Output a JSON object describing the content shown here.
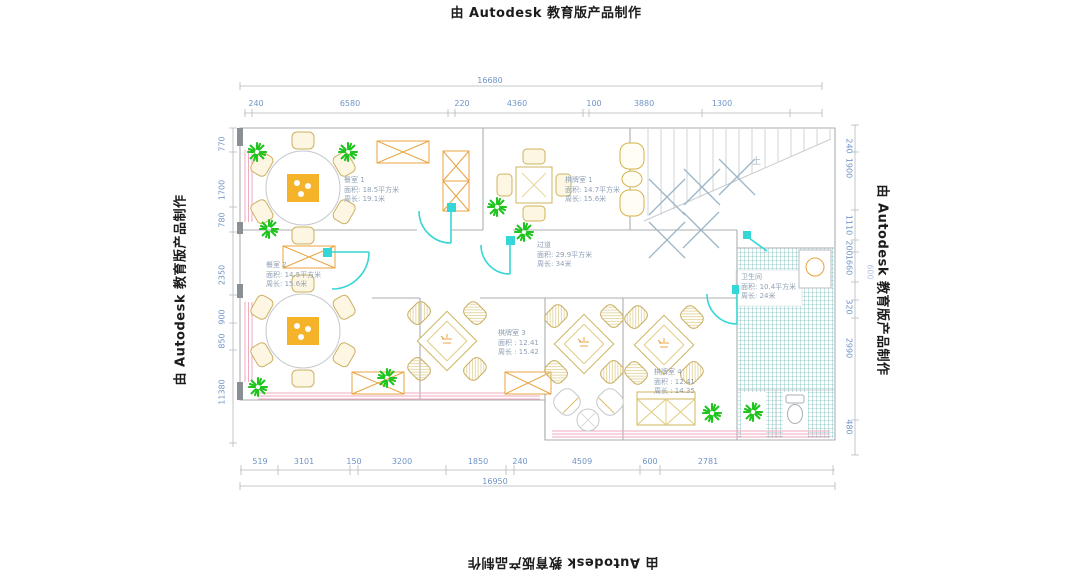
{
  "watermark": {
    "text": "由 Autodesk 教育版产品制作"
  },
  "dimensions": {
    "top": {
      "total": "16680",
      "segments": [
        "240",
        "6580",
        "220",
        "4360",
        "100",
        "3880",
        "1300"
      ]
    },
    "bottom": {
      "total": "16950",
      "segments": [
        "519",
        "3101",
        "150",
        "3200",
        "1850",
        "240",
        "4509",
        "600",
        "2781"
      ]
    },
    "left": {
      "segments": [
        "770",
        "1700",
        "780",
        "2350",
        "900",
        "850",
        "11380"
      ]
    },
    "right": {
      "segments": [
        "240",
        "1900",
        "1110",
        "200",
        "1660",
        "600",
        "320",
        "2990",
        "480"
      ]
    }
  },
  "rooms": [
    {
      "name": "餐室 1",
      "area": "面积: 18.5平方米",
      "perimeter": "周长: 19.1米"
    },
    {
      "name": "棋牌室 1",
      "area": "面积: 14.7平方米",
      "perimeter": "周长: 15.6米"
    },
    {
      "name": "过道",
      "area": "面积: 29.9平方米",
      "perimeter": "周长: 34米"
    },
    {
      "name": "餐室 2",
      "area": "面积: 14.5平方米",
      "perimeter": "周长: 15.6米"
    },
    {
      "name": "棋牌室 3",
      "area": "面积 : 12.41",
      "perimeter": "周长 : 15.42"
    },
    {
      "name": "棋牌室 4",
      "area": "面积 : 12.41",
      "perimeter": "周长 : 14.35"
    },
    {
      "name": "卫生间",
      "area": "面积: 10.4平方米",
      "perimeter": "周长: 24米"
    }
  ],
  "annotations": {
    "stairs_up": "上"
  },
  "colors": {
    "dimension_text": "#7094c8",
    "drawing_line": "#b4b8bc",
    "wall_gray": "#8a8f94",
    "window_pink": "#f2aabe",
    "furniture_orange": "#e8a33d",
    "furniture_tan": "#d0b45a",
    "plant_green": "#1fc41f",
    "door_cyan": "#35d6d6",
    "tile_teal": "#3fa3a5",
    "stair_hatch": "#9cb6c6"
  }
}
